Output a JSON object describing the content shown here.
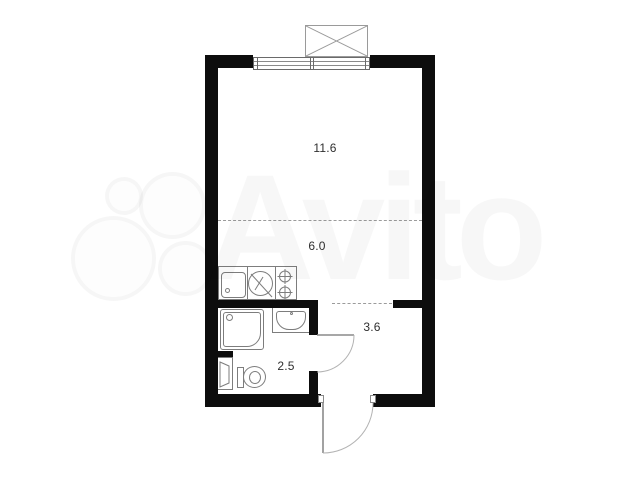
{
  "watermark": {
    "text": "Avito",
    "logo": "avito-four-circles"
  },
  "rooms": [
    {
      "id": "living-room",
      "area": "11.6"
    },
    {
      "id": "kitchen-zone",
      "area": "6.0"
    },
    {
      "id": "hallway",
      "area": "3.6"
    },
    {
      "id": "bathroom",
      "area": "2.5"
    }
  ],
  "icons": [
    "vent-shaft-icon",
    "window",
    "kitchen-sink-icon",
    "washing-machine-icon",
    "stove-burners-icon",
    "shower-icon",
    "washbasin-icon",
    "toilet-icon",
    "laundry-unit-icon",
    "bathroom-door",
    "entrance-door"
  ],
  "colors": {
    "wall": "#0d0d0d",
    "line": "#7d7d7d",
    "dashline": "#9b9b9b",
    "label": "#2f2f2f",
    "watermark": "rgba(0,0,0,0.032)"
  }
}
